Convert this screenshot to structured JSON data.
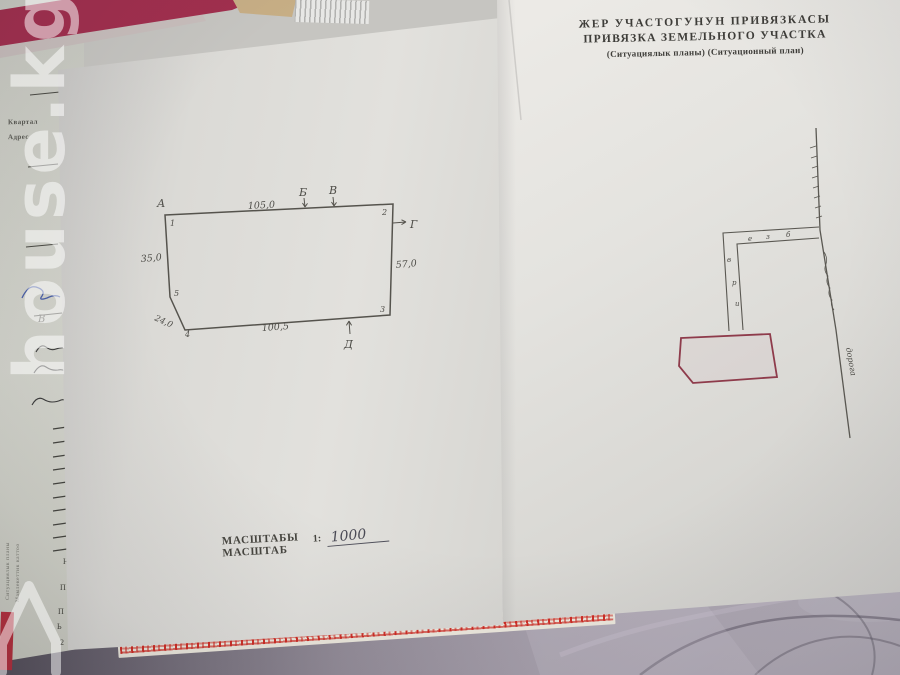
{
  "watermark": {
    "text": "house.kg"
  },
  "left_page": {
    "plot": {
      "point_a": "А",
      "point_b": "Б",
      "point_v": "В",
      "point_g": "Г",
      "point_d": "Д",
      "corner_1": "1",
      "corner_2": "2",
      "corner_3": "3",
      "corner_4": "4",
      "corner_5": "5",
      "dim_top": "105,0",
      "dim_left": "35,0",
      "dim_right": "57,0",
      "dim_bottom": "100,5",
      "dim_diag": "24,0"
    },
    "scale": {
      "title_ky": "МАСШТАБЫ",
      "title_ru": "МАСШТАБ",
      "prefix": "1:",
      "value": "1000"
    }
  },
  "right_page": {
    "header": {
      "line1": "ЖЕР УЧАСТОГУНУН ПРИВЯЗКАСЫ",
      "line2": "ПРИВЯЗКА ЗЕМЕЛЬНОГО УЧАСТКА",
      "line3": "(Ситуациялык планы)  (Ситуационный план)"
    },
    "sitplan": {
      "road_label": "дорога",
      "marks_top": [
        "е",
        "з",
        "б"
      ],
      "marks_left": [
        "в",
        "р",
        "и"
      ]
    }
  },
  "under_page": {
    "field_quartal": "Квартал",
    "field_address": "Адрес",
    "mark_b": "В",
    "letters": [
      "Н",
      "П",
      "П",
      "Ь",
      "2"
    ],
    "vertical_line1": "Ситуациялык планы",
    "vertical_line2": "Мамлекеттик каттоо"
  }
}
